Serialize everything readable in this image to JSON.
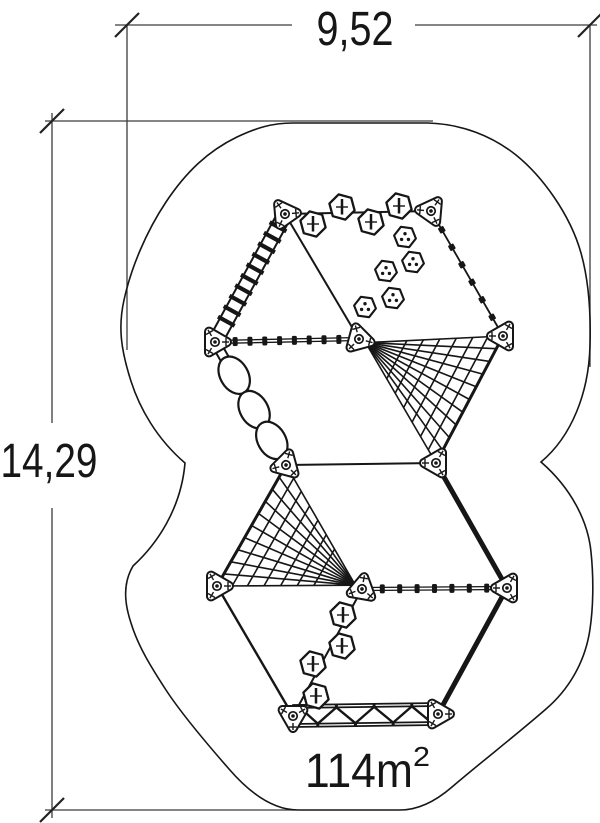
{
  "page": {
    "bg": "#ffffff",
    "ink": "#161616",
    "dim_ink": "#3c3c3c"
  },
  "labels": {
    "width": "9,52",
    "height": "14,29",
    "area": "114m",
    "area_sup": "2"
  },
  "canvas": {
    "w": 600,
    "h": 823
  },
  "dimensions": {
    "lines": [
      [
        115,
        25,
        292,
        25
      ],
      [
        415,
        25,
        597,
        25
      ],
      [
        52,
        113,
        52,
        423
      ],
      [
        52,
        508,
        52,
        818
      ],
      [
        127,
        25,
        127,
        350
      ],
      [
        590,
        25,
        590,
        367
      ],
      [
        45,
        121,
        433,
        121
      ],
      [
        45,
        810,
        295,
        810
      ]
    ],
    "ticks": [
      [
        127,
        25
      ],
      [
        590,
        25
      ],
      [
        52,
        121
      ],
      [
        52,
        810
      ]
    ],
    "texts": [
      {
        "bind": "labels.width",
        "name": "width-dimension-label",
        "x": 355,
        "y": 45,
        "size": 48,
        "len": 77,
        "anchor": "middle"
      },
      {
        "bind": "labels.height",
        "name": "height-dimension-label",
        "x": 49,
        "y": 477,
        "size": 48,
        "len": 97,
        "anchor": "middle"
      },
      {
        "bind": "labels.area",
        "name": "area-label",
        "x": 359,
        "y": 787,
        "size": 48,
        "len": 108,
        "anchor": "middle"
      },
      {
        "bind": "labels.area_sup",
        "name": "area-superscript",
        "x": 413,
        "y": 766,
        "size": 28,
        "len": 17,
        "anchor": "start"
      }
    ]
  },
  "boundary": {
    "path": "M 293,123 L 428,123 C 462,124 492,136 516,155 C 542,176 570,214 581,253 C 588,278 591,310 590,345 C 589,392 572,436 541,462 C 571,488 588,521 591,552 C 594,581 593,609 590,629 C 585,664 567,691 546,709 C 515,736 480,763 452,787 C 437,800 420,810 400,810 L 298,810 C 272,810 248,791 229,769 C 208,745 181,713 166,690 C 151,667 138,646 131,623 C 124,602 123,583 133,566 C 157,544 181,509 185,463 C 157,439 139,408 130,378 C 121,349 118,327 124,300 C 131,268 146,232 166,202 C 186,172 208,151 237,137 C 256,128 272,123 293,123 Z"
  },
  "structure": {
    "posts": [
      {
        "x": 285,
        "y": 214,
        "rot": 115
      },
      {
        "x": 431,
        "y": 211,
        "rot": 65
      },
      {
        "x": 215,
        "y": 342,
        "rot": 0
      },
      {
        "x": 359,
        "y": 339,
        "rot": 255
      },
      {
        "x": 503,
        "y": 336,
        "rot": 180
      },
      {
        "x": 286,
        "y": 465,
        "rot": 285
      },
      {
        "x": 436,
        "y": 463,
        "rot": 180
      },
      {
        "x": 217,
        "y": 586,
        "rot": 0
      },
      {
        "x": 362,
        "y": 589,
        "rot": 160
      },
      {
        "x": 507,
        "y": 588,
        "rot": 180
      },
      {
        "x": 293,
        "y": 716,
        "rot": 90
      },
      {
        "x": 438,
        "y": 714,
        "rot": 0
      }
    ],
    "elements": [
      {
        "type": "line",
        "a": 0,
        "b": 1,
        "w": 2
      },
      {
        "type": "line",
        "a": 0,
        "b": 3,
        "w": 2
      },
      {
        "type": "clamps",
        "a": 1,
        "b": 4,
        "n": 6
      },
      {
        "type": "ladder",
        "a": 0,
        "b": 2
      },
      {
        "type": "beads",
        "a": 2,
        "b": 3,
        "n": 8
      },
      {
        "type": "net",
        "apex": 3,
        "ea": 4,
        "eb": 6
      },
      {
        "type": "discs",
        "a": 2,
        "b": 5
      },
      {
        "type": "line",
        "a": 5,
        "b": 6,
        "w": 2
      },
      {
        "type": "thick",
        "a": 6,
        "b": 9
      },
      {
        "type": "net",
        "apex": 8,
        "ea": 5,
        "eb": 7
      },
      {
        "type": "line",
        "a": 7,
        "b": 10,
        "w": 2.4
      },
      {
        "type": "line",
        "a": 8,
        "b": 10,
        "w": 2
      },
      {
        "type": "beads",
        "a": 8,
        "b": 9,
        "n": 7
      },
      {
        "type": "thick",
        "a": 9,
        "b": 11
      },
      {
        "type": "bridge",
        "a": 10,
        "b": 11
      }
    ],
    "hex_cross": [
      [
        342,
        207
      ],
      [
        399,
        206
      ],
      [
        313,
        224
      ],
      [
        371,
        222
      ],
      [
        343,
        615
      ],
      [
        342,
        646
      ],
      [
        313,
        664
      ],
      [
        316,
        696
      ]
    ],
    "hex_dots": [
      [
        405,
        237
      ],
      [
        413,
        262
      ],
      [
        386,
        271
      ],
      [
        393,
        298
      ],
      [
        365,
        307
      ]
    ]
  }
}
